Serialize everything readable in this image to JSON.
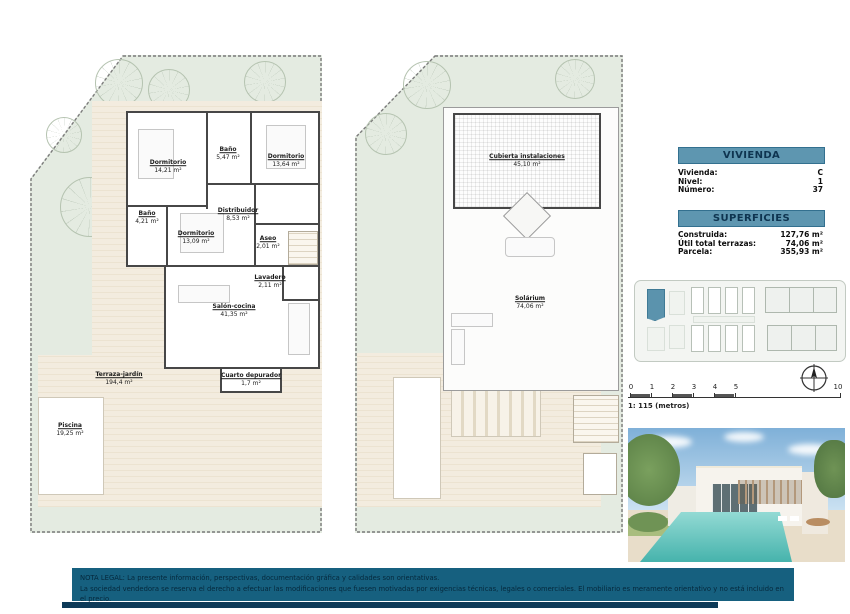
{
  "colors": {
    "accent_teal": "#5e96b0",
    "legal_bar": "#16607f",
    "garden_green": "#e4ebe1",
    "terrace_beige": "#f3ecdf",
    "wall_dark": "#474747",
    "highlight_unit": "#5b93ad"
  },
  "vivienda_panel": {
    "title": "VIVIENDA",
    "rows": [
      {
        "label": "Vivienda:",
        "value": "C"
      },
      {
        "label": "Nivel:",
        "value": "1"
      },
      {
        "label": "Número:",
        "value": "37"
      }
    ]
  },
  "superficies_panel": {
    "title": "SUPERFICIES",
    "rows": [
      {
        "label": "Construida:",
        "value": "127,76 m²"
      },
      {
        "label": "Útil total terrazas:",
        "value": "74,06 m²"
      },
      {
        "label": "Parcela:",
        "value": "355,93 m²"
      }
    ]
  },
  "floorplan_level1": {
    "rooms": [
      {
        "name": "Dormitorio",
        "area": "14,21 m²"
      },
      {
        "name": "Baño",
        "area": "5,47 m²"
      },
      {
        "name": "Dormitorio",
        "area": "13,64 m²"
      },
      {
        "name": "Baño",
        "area": "4,21 m²"
      },
      {
        "name": "Distribuidor",
        "area": "8,53 m²"
      },
      {
        "name": "Dormitorio",
        "area": "13,09 m²"
      },
      {
        "name": "Aseo",
        "area": "2,01 m²"
      },
      {
        "name": "Lavadero",
        "area": "2,11 m²"
      },
      {
        "name": "Salón-cocina",
        "area": "41,35 m²"
      },
      {
        "name": "Terraza-jardín",
        "area": "194,4 m²"
      },
      {
        "name": "Piscina",
        "area": "19,25 m²"
      },
      {
        "name": "Cuarto depurador",
        "area": "1,7 m²"
      }
    ]
  },
  "floorplan_roof": {
    "rooms": [
      {
        "name": "Cubierta instalaciones",
        "area": "45,10 m²"
      },
      {
        "name": "Solárium",
        "area": "74,06 m²"
      }
    ]
  },
  "scalebar": {
    "ticks": [
      "0",
      "1",
      "2",
      "3",
      "4",
      "5",
      "10"
    ],
    "caption": "1: 115 (metros)"
  },
  "legal": {
    "line1": "NOTA LEGAL: La presente información, perspectivas, documentación gráfica y calidades son orientativas.",
    "line2": "La sociedad vendedora se reserva el derecho a efectuar las modificaciones que fuesen motivadas por exigencias técnicas, legales o comerciales. El mobiliario es meramente orientativo y no está incluido en el precio."
  }
}
